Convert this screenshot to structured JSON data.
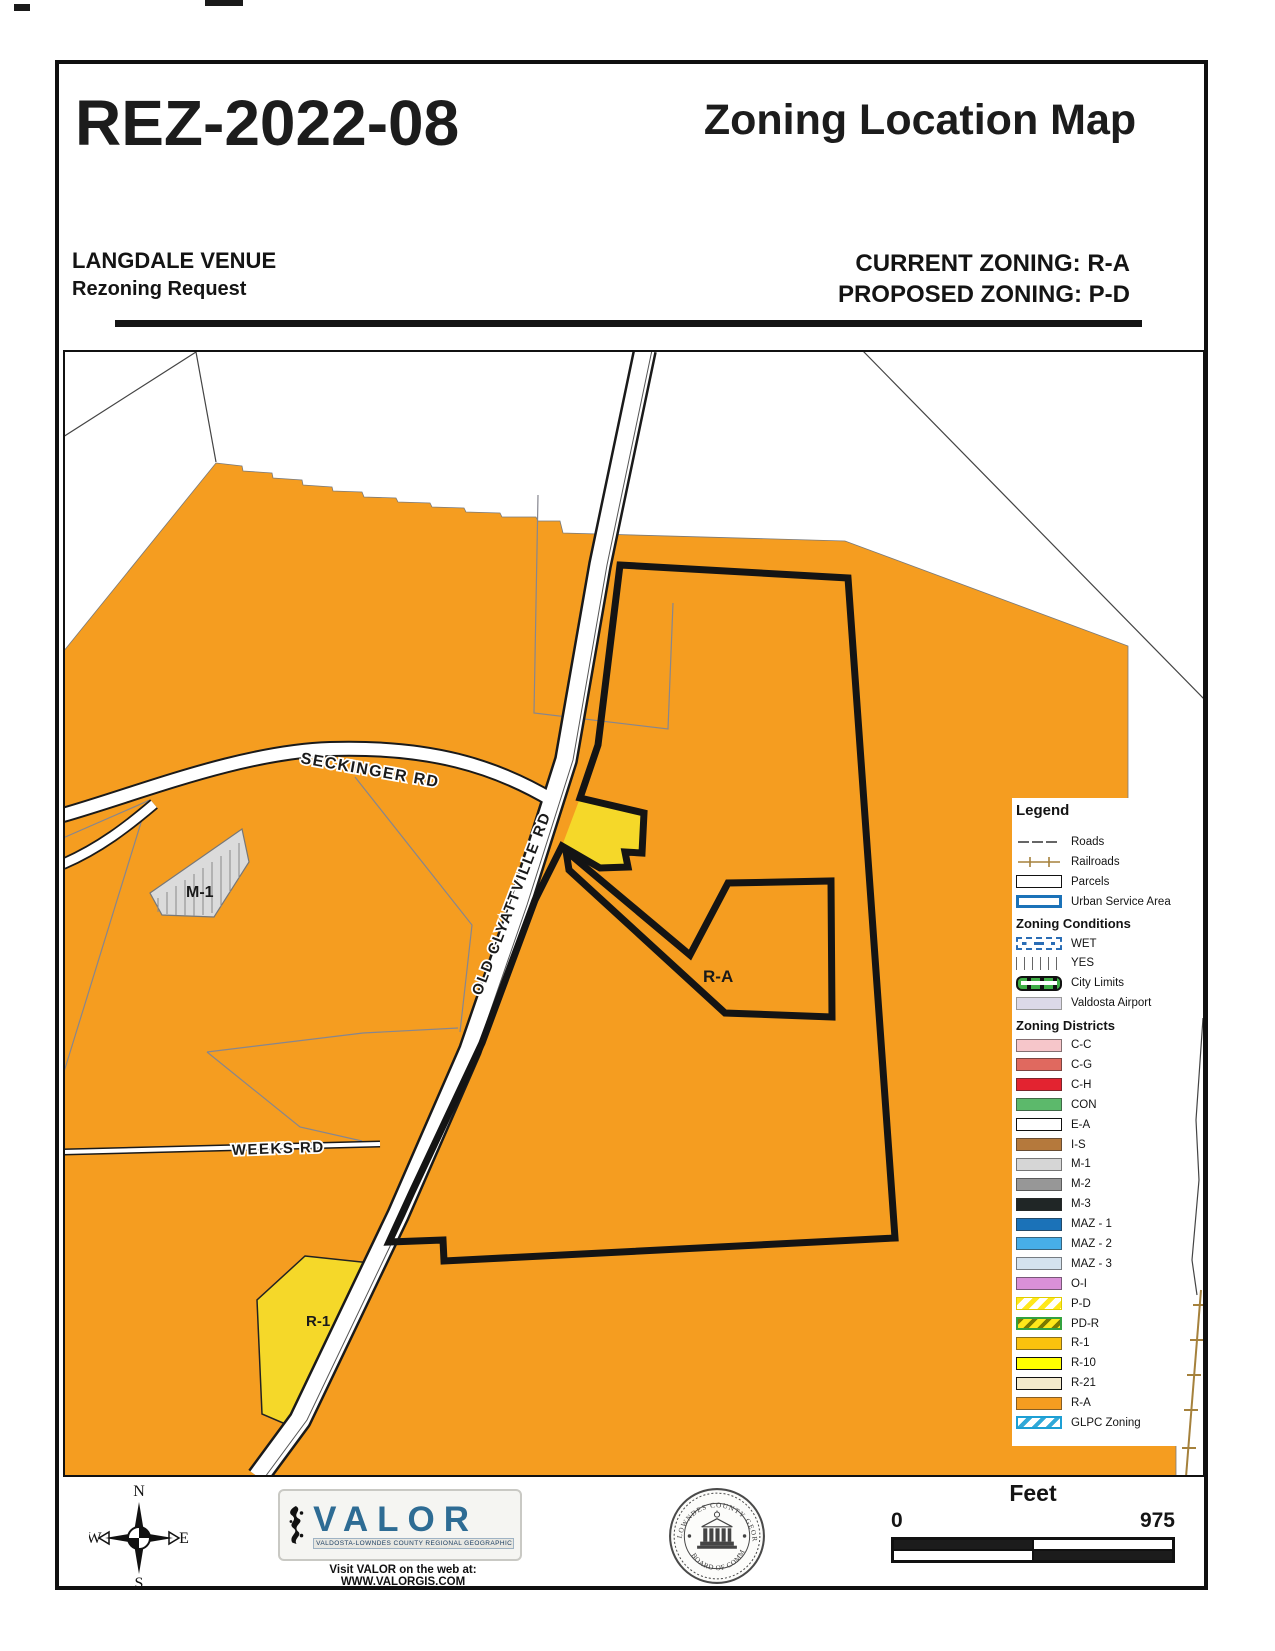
{
  "page": {
    "case_number": "REZ-2022-08",
    "map_title": "Zoning Location Map",
    "applicant": "LANGDALE VENUE",
    "request_type": "Rezoning Request",
    "current_zoning": "CURRENT ZONING: R-A",
    "proposed_zoning": "PROPOSED ZONING: P-D"
  },
  "map": {
    "labels": {
      "seckinger": "SECKINGER RD",
      "old_clyattville": "OLD CLYATTVILLE RD",
      "weeks": "WEEKS RD",
      "m1": "M-1",
      "ra": "R-A",
      "r1": "R-1"
    }
  },
  "legend": {
    "title": "Legend",
    "base": [
      {
        "label": "Roads"
      },
      {
        "label": "Railroads"
      },
      {
        "label": "Parcels"
      },
      {
        "label": "Urban Service Area"
      }
    ],
    "conditions_title": "Zoning Conditions",
    "conditions": [
      {
        "label": "WET",
        "color": "#2A6DB5"
      },
      {
        "label": "YES",
        "color": "#666666"
      },
      {
        "label": "City Limits",
        "color": "#3FAE46"
      },
      {
        "label": "Valdosta Airport",
        "color": "#DCD9E8"
      }
    ],
    "districts_title": "Zoning Districts",
    "districts": [
      {
        "label": "C-C",
        "color": "#F6C6CA"
      },
      {
        "label": "C-G",
        "color": "#E0695F"
      },
      {
        "label": "C-H",
        "color": "#E32330"
      },
      {
        "label": "CON",
        "color": "#5CB96B"
      },
      {
        "label": "E-A",
        "color": "#FFFFFF"
      },
      {
        "label": "I-S",
        "color": "#B5793C"
      },
      {
        "label": "M-1",
        "color": "#D6D6D6"
      },
      {
        "label": "M-2",
        "color": "#979797"
      },
      {
        "label": "M-3",
        "color": "#202626"
      },
      {
        "label": "MAZ - 1",
        "color": "#1B72B8"
      },
      {
        "label": "MAZ - 2",
        "color": "#47AEE8"
      },
      {
        "label": "MAZ - 3",
        "color": "#D4E2EE"
      },
      {
        "label": "O-I",
        "color": "#DA90D8"
      },
      {
        "label": "P-D",
        "color": "#FFE81A"
      },
      {
        "label": "PD-R",
        "color": "#33A23F"
      },
      {
        "label": "R-1",
        "color": "#FBC20D"
      },
      {
        "label": "R-10",
        "color": "#FFFF00"
      },
      {
        "label": "R-21",
        "color": "#F3EACC"
      },
      {
        "label": "R-A",
        "color": "#F59D20"
      },
      {
        "label": "GLPC Zoning",
        "color": "#1D9FD4"
      }
    ]
  },
  "footer": {
    "compass": {
      "n": "N",
      "e": "E",
      "s": "S",
      "w": "W"
    },
    "valor": {
      "name": "VALOR",
      "tagline": "VALDOSTA-LOWNDES COUNTY REGIONAL GEOGRAPHIC INFORMATION SYSTEM",
      "web": "Visit VALOR on the web at: WWW.VALORGIS.COM"
    },
    "seal": {
      "top": "LOWNDES COUNTY GEORGIA",
      "bottom": "BOARD OF COMMISSIONERS"
    },
    "scale": {
      "units": "Feet",
      "min": "0",
      "max": "975"
    }
  },
  "colors": {
    "ra_orange": "#F59D20",
    "parcel_yellow": "#F5D829",
    "subject_boundary": "#141414",
    "railroad_tan": "#A5813C",
    "valor_blue": "#2E6C94"
  }
}
